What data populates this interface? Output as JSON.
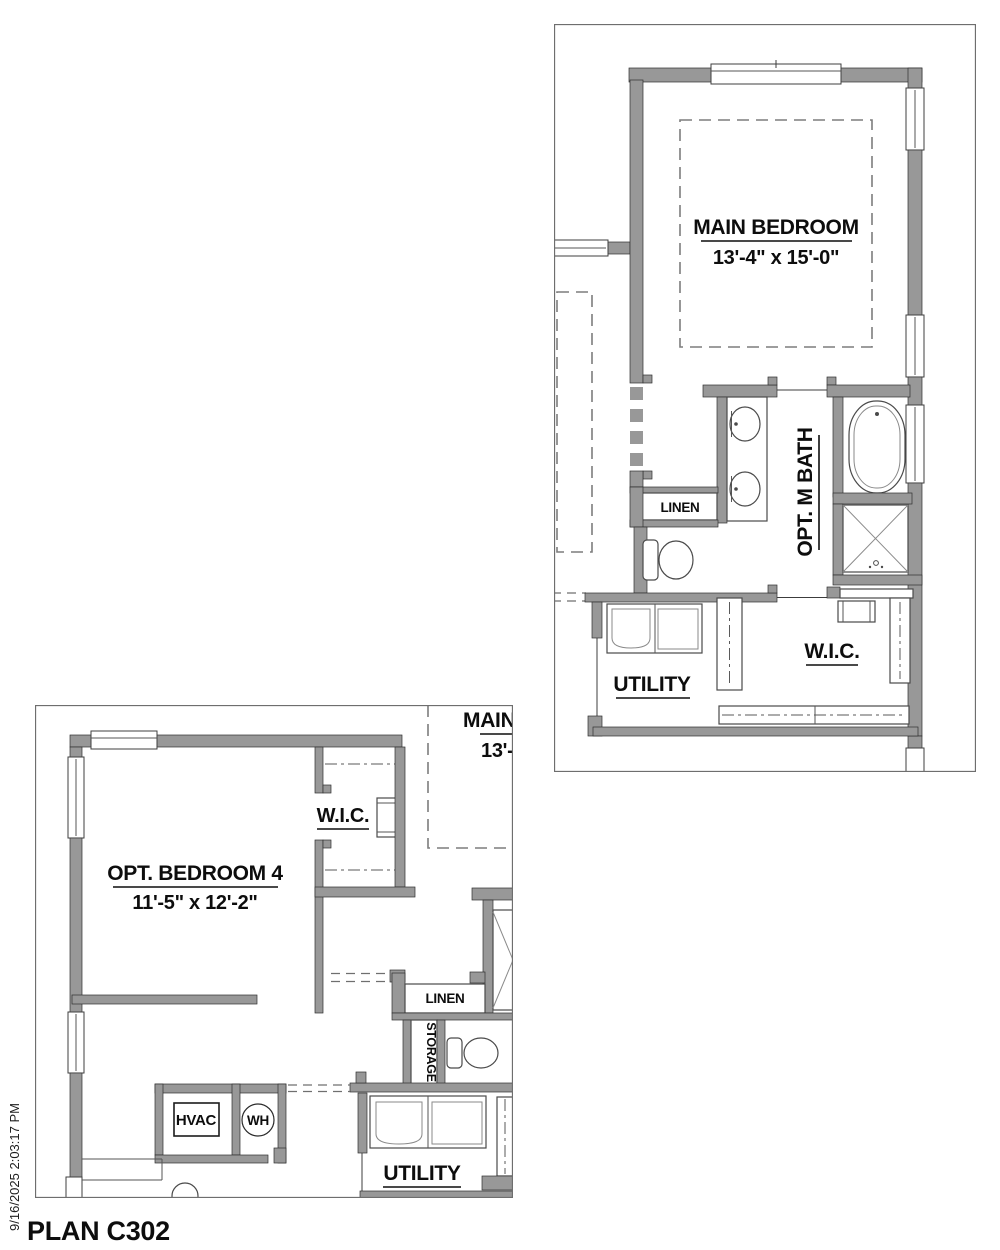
{
  "plan_title": "PLAN C302",
  "timestamp": "9/16/2025 2:03:17 PM",
  "view_main": {
    "main_bedroom": {
      "name": "MAIN BEDROOM",
      "dims": "13'-4\" x 15'-0\""
    },
    "bath_label": "OPT. M BATH",
    "linen_label": "LINEN",
    "utility_label": "UTILITY",
    "wic_label": "W.I.C."
  },
  "view_bed4": {
    "bedroom4": {
      "name": "OPT. BEDROOM 4",
      "dims": "11'-5\" x 12'-2\""
    },
    "wic_label": "W.I.C.",
    "linen_label": "LINEN",
    "storage_label": "STORAGE",
    "hvac_label": "HVAC",
    "wh_label": "WH",
    "utility_label": "UTILITY",
    "main_bedroom_clipped": {
      "name": "MAIN BEDROOM",
      "dims": "13'-4\" x 15'-0\""
    }
  },
  "colors": {
    "wall_fill": "#989898",
    "wall_outline": "#2f2f2f",
    "thin_line": "#3c3c3c",
    "dashed_line": "#7d7d7d",
    "text": "#0d0d0d",
    "view_border": "#6e6e6e",
    "background": "#ffffff"
  }
}
